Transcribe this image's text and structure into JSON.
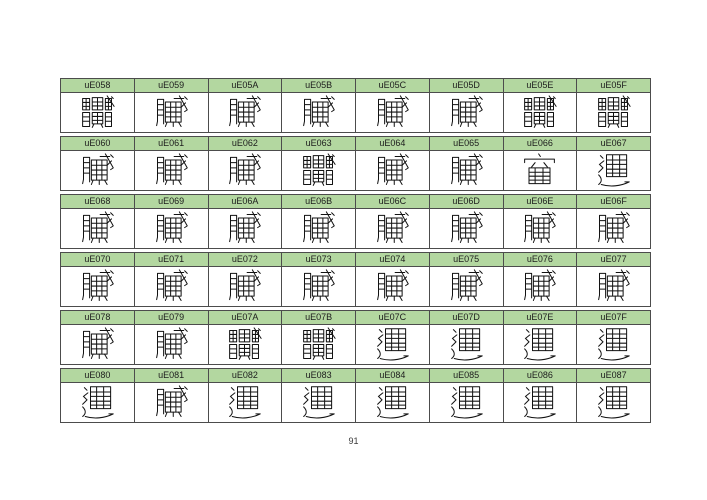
{
  "page": {
    "number": "91"
  },
  "colors": {
    "header_bg": "#b3d7a0",
    "border": "#4c4c4c",
    "header_text": "#1c1c1c",
    "glyph": "#121212"
  },
  "table": {
    "description": "Private Use Area glyph specimen chart: each group has a green header row of code point labels and a row of complex CJK-style glyphs",
    "groups": [
      {
        "cells": [
          {
            "code": "uE058",
            "glyph": "dense-stack"
          },
          {
            "code": "uE059",
            "glyph": "dense-lr"
          },
          {
            "code": "uE05A",
            "glyph": "dense-lr"
          },
          {
            "code": "uE05B",
            "glyph": "dense-lr"
          },
          {
            "code": "uE05C",
            "glyph": "dense-lr"
          },
          {
            "code": "uE05D",
            "glyph": "dense-lr"
          },
          {
            "code": "uE05E",
            "glyph": "dense-stack"
          },
          {
            "code": "uE05F",
            "glyph": "dense-stack"
          }
        ]
      },
      {
        "cells": [
          {
            "code": "uE060",
            "glyph": "dense-lr"
          },
          {
            "code": "uE061",
            "glyph": "dense-lr"
          },
          {
            "code": "uE062",
            "glyph": "dense-lr"
          },
          {
            "code": "uE063",
            "glyph": "dense-stack"
          },
          {
            "code": "uE064",
            "glyph": "dense-lr"
          },
          {
            "code": "uE065",
            "glyph": "dense-lr"
          },
          {
            "code": "uE066",
            "glyph": "dense-roof"
          },
          {
            "code": "uE067",
            "glyph": "dense-walk"
          }
        ]
      },
      {
        "cells": [
          {
            "code": "uE068",
            "glyph": "dense-lr"
          },
          {
            "code": "uE069",
            "glyph": "dense-lr"
          },
          {
            "code": "uE06A",
            "glyph": "dense-lr"
          },
          {
            "code": "uE06B",
            "glyph": "dense-lr"
          },
          {
            "code": "uE06C",
            "glyph": "dense-lr"
          },
          {
            "code": "uE06D",
            "glyph": "dense-lr"
          },
          {
            "code": "uE06E",
            "glyph": "dense-lr"
          },
          {
            "code": "uE06F",
            "glyph": "dense-lr"
          }
        ]
      },
      {
        "cells": [
          {
            "code": "uE070",
            "glyph": "dense-lr"
          },
          {
            "code": "uE071",
            "glyph": "dense-lr"
          },
          {
            "code": "uE072",
            "glyph": "dense-lr"
          },
          {
            "code": "uE073",
            "glyph": "dense-lr"
          },
          {
            "code": "uE074",
            "glyph": "dense-lr"
          },
          {
            "code": "uE075",
            "glyph": "dense-lr"
          },
          {
            "code": "uE076",
            "glyph": "dense-lr"
          },
          {
            "code": "uE077",
            "glyph": "dense-lr"
          }
        ]
      },
      {
        "cells": [
          {
            "code": "uE078",
            "glyph": "dense-lr"
          },
          {
            "code": "uE079",
            "glyph": "dense-lr"
          },
          {
            "code": "uE07A",
            "glyph": "dense-stack"
          },
          {
            "code": "uE07B",
            "glyph": "dense-stack"
          },
          {
            "code": "uE07C",
            "glyph": "dense-walk"
          },
          {
            "code": "uE07D",
            "glyph": "dense-walk"
          },
          {
            "code": "uE07E",
            "glyph": "dense-walk"
          },
          {
            "code": "uE07F",
            "glyph": "dense-walk"
          }
        ]
      },
      {
        "cells": [
          {
            "code": "uE080",
            "glyph": "dense-walk"
          },
          {
            "code": "uE081",
            "glyph": "dense-lr"
          },
          {
            "code": "uE082",
            "glyph": "dense-walk"
          },
          {
            "code": "uE083",
            "glyph": "dense-walk"
          },
          {
            "code": "uE084",
            "glyph": "dense-walk"
          },
          {
            "code": "uE085",
            "glyph": "dense-walk"
          },
          {
            "code": "uE086",
            "glyph": "dense-walk"
          },
          {
            "code": "uE087",
            "glyph": "dense-walk"
          }
        ]
      }
    ]
  }
}
